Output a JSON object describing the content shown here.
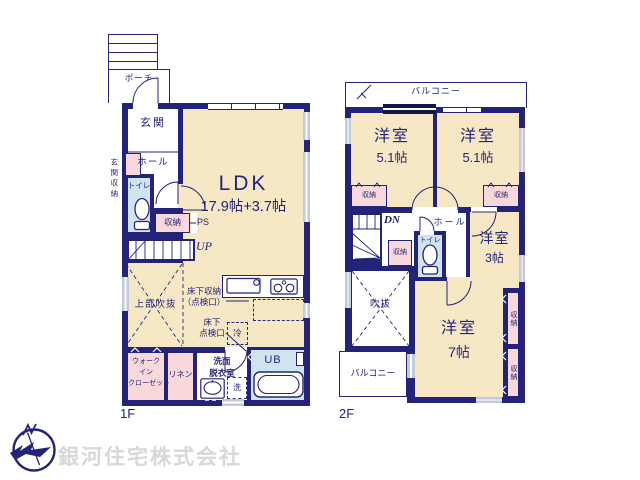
{
  "shared": {
    "storage": "収納"
  },
  "floor1": {
    "floor_label": "1F",
    "porch": "ポーチ",
    "entrance": "玄関",
    "entrance_storage": "玄関収納",
    "hall": "ホール",
    "toilet": "トイレ",
    "ps": "PS",
    "stairs_up": "UP",
    "ldk_name": "LDK",
    "ldk_size": "17.9帖+3.7帖",
    "open_to_above": "上部吹抜",
    "underfloor_storage_line1": "床下収納",
    "underfloor_storage_line2": "（点検口）",
    "underfloor_hatch_line1": "床下",
    "underfloor_hatch_line2": "点検口",
    "refrigerator": "冷",
    "wic_line1": "ウォーク",
    "wic_line2": "イン",
    "wic_line3": "クローゼット",
    "linen": "リネン",
    "washroom_line1": "洗面",
    "washroom_line2": "脱衣室",
    "laundry": "洗",
    "unit_bath": "UB"
  },
  "floor2": {
    "floor_label": "2F",
    "balcony_top": "バルコニー",
    "balcony_bottom": "バルコニー",
    "room_a_name": "洋室",
    "room_a_size": "5.1帖",
    "room_b_name": "洋室",
    "room_b_size": "5.1帖",
    "room_c_name": "洋室",
    "room_c_size": "3帖",
    "room_d_name": "洋室",
    "room_d_size": "7帖",
    "stairs_down": "DN",
    "hall": "ホール",
    "toilet": "トイレ",
    "void": "吹抜"
  },
  "company": {
    "name": "銀河住宅株式会社"
  },
  "colors": {
    "wall_navy": "#23237a",
    "room_beige": "#f7e8c5",
    "closet_pink": "#f8d8da",
    "wet_area_blue": "#cfe3f1",
    "window_gray": "#ccd2de",
    "company_gray": "#d8d8d8"
  }
}
